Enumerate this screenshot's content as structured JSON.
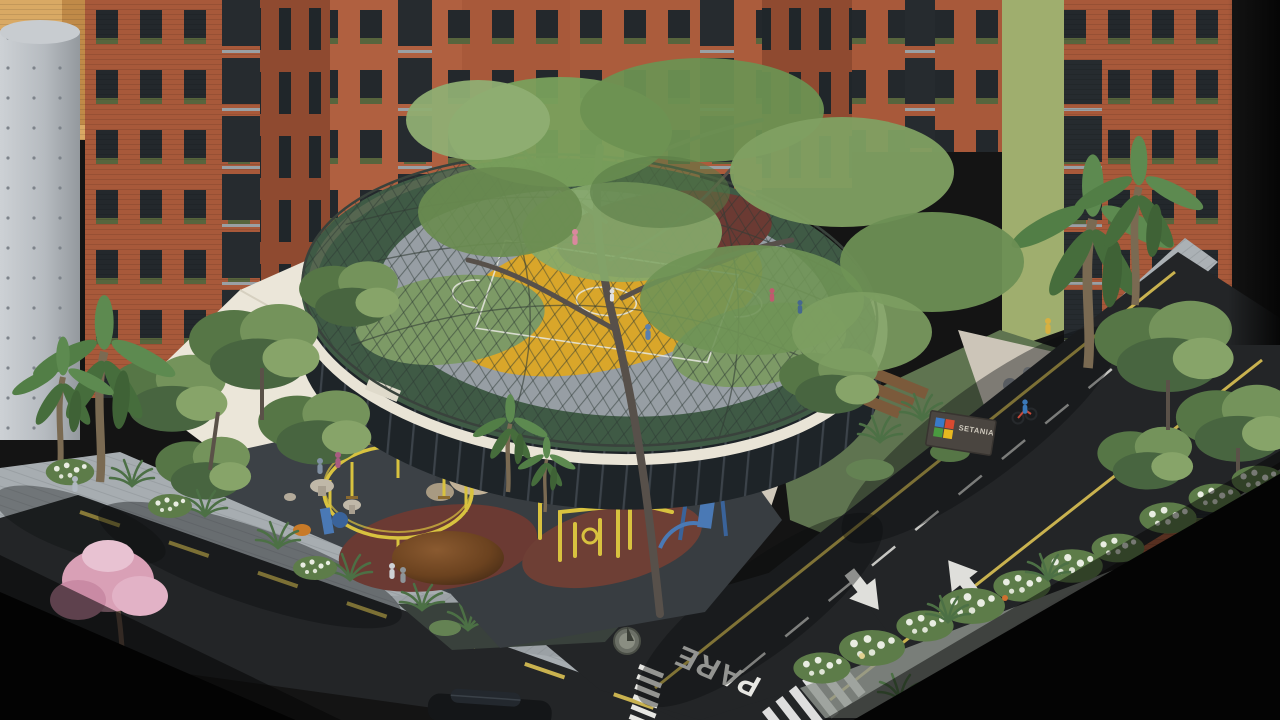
{
  "scene": {
    "description": "Aerial isometric architectural rendering: brick residential towers around a circular community pavilion with a netted dome over a rooftop sports court, playground plaza, landscaped streets",
    "road_markings": {
      "stop_text": "PARE"
    },
    "sign": {
      "text": "SETANIA"
    },
    "palette": {
      "brick": "#a8593a",
      "brick_dark": "#8f4a30",
      "yellow_brick": "#d9a964",
      "concrete": "#bdc1c5",
      "canopy_white": "#ebe6d9",
      "track_green": "#3f5a45",
      "court_gray": "#979ea4",
      "court_yellow": "#d9a62a",
      "court_maroon": "#6b3a33",
      "court_green": "#7d9a66",
      "glass_dark": "#1e2428",
      "asphalt": "#232527",
      "sidewalk": "#a7adb1",
      "foliage": "#6f8f55",
      "pink_blossom": "#d9a0b6",
      "equipment_yellow": "#d8c23f",
      "equipment_blue": "#4a79b5",
      "lane_yellow": "#c9b24f",
      "marking_white": "#e7e7e3",
      "sign_blue": "#3a7ac8",
      "sign_red": "#d84a30",
      "sign_green": "#4a9a40",
      "sign_yellow": "#e8b820"
    }
  }
}
